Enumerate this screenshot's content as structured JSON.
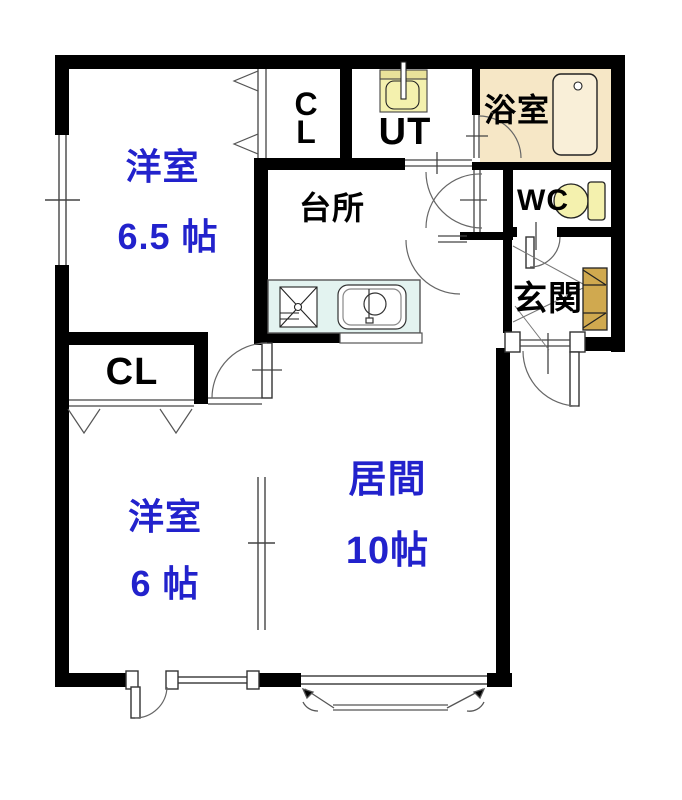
{
  "title": "2LDK apartment floor plan",
  "colors": {
    "wall": "#000000",
    "label_blue": "#2222cc",
    "bathroom_floor": "#f6e7c6",
    "tub_fill": "#f9efd8",
    "kitchen_counter": "#e3f3f0",
    "pale_yellow_fixture": "#f4f1ae",
    "washer_band": "#e9e29a",
    "shoe_cabinet": "#d0a94f",
    "line": "#555555"
  },
  "rooms": {
    "western_room_1": {
      "name": "洋室",
      "size": "6.5 帖"
    },
    "western_room_2": {
      "name": "洋室",
      "size": "6 帖"
    },
    "living_room": {
      "name": "居間",
      "size": "10帖"
    },
    "kitchen": {
      "name": "台所"
    },
    "bathroom": {
      "name": "浴室"
    },
    "toilet": {
      "name": "WC"
    },
    "entrance": {
      "name": "玄関"
    },
    "utility": {
      "name": "UT"
    },
    "closet_upper": {
      "line1": "C",
      "line2": "L"
    },
    "closet_lower": {
      "name": "CL"
    }
  },
  "fixtures": {
    "bathtub": "bathtub-icon",
    "toilet": "toilet-icon",
    "washer_pan": "washing-machine-pan-icon",
    "kitchen_sink": "kitchen-sink-icon",
    "stove": "stove-icon",
    "shoe_cabinet": "shoe-cabinet-icon"
  }
}
